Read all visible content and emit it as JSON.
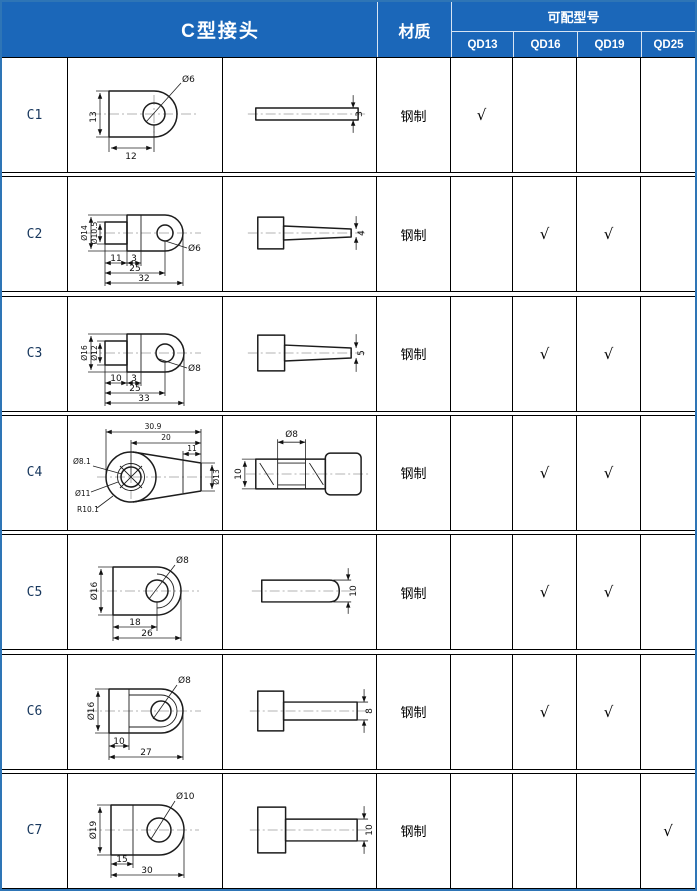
{
  "colors": {
    "header_bg": "#1b67b9",
    "outer_border": "#2e75b6",
    "grid_line": "#000000",
    "row_id_color": "#17375d"
  },
  "header": {
    "title": "C型接头",
    "material": "材质",
    "compat": "可配型号",
    "models": [
      "QD13",
      "QD16",
      "QD19",
      "QD25"
    ]
  },
  "rows": [
    {
      "id": "C1",
      "material": "钢制",
      "checkmarks": [
        "√",
        "",
        "",
        ""
      ],
      "front": {
        "hole": "Ø6",
        "height": "13",
        "width": "12"
      },
      "side": {
        "thickness": "3"
      }
    },
    {
      "id": "C2",
      "material": "钢制",
      "checkmarks": [
        "",
        "√",
        "√",
        ""
      ],
      "front": {
        "outer": "Ø14",
        "inner": "Ø10.5",
        "seg1": "11",
        "seg2": "3",
        "mid": "25",
        "total": "32",
        "hole": "Ø6"
      },
      "side": {
        "thickness": "4"
      }
    },
    {
      "id": "C3",
      "material": "钢制",
      "checkmarks": [
        "",
        "√",
        "√",
        ""
      ],
      "front": {
        "outer": "Ø16",
        "inner": "Ø12",
        "seg1": "10",
        "seg2": "3",
        "mid": "25",
        "total": "33",
        "hole": "Ø8"
      },
      "side": {
        "thickness": "5"
      }
    },
    {
      "id": "C4",
      "material": "钢制",
      "checkmarks": [
        "",
        "√",
        "√",
        ""
      ],
      "front": {
        "total": "30.9",
        "mid": "20",
        "seg": "11",
        "hole": "Ø8.1",
        "ring": "Ø11",
        "radius": "R10.1",
        "right": "Ø13"
      },
      "side": {
        "top": "Ø8",
        "height": "10"
      }
    },
    {
      "id": "C5",
      "material": "钢制",
      "checkmarks": [
        "",
        "√",
        "√",
        ""
      ],
      "front": {
        "outer": "Ø16",
        "hole": "Ø8",
        "seg": "18",
        "total": "26"
      },
      "side": {
        "thickness": "10"
      }
    },
    {
      "id": "C6",
      "material": "钢制",
      "checkmarks": [
        "",
        "√",
        "√",
        ""
      ],
      "front": {
        "outer": "Ø16",
        "hole": "Ø8",
        "seg": "10",
        "total": "27"
      },
      "side": {
        "thickness": "8"
      }
    },
    {
      "id": "C7",
      "material": "钢制",
      "checkmarks": [
        "",
        "",
        "",
        "√"
      ],
      "front": {
        "outer": "Ø19",
        "hole": "Ø10",
        "seg": "15",
        "total": "30"
      },
      "side": {
        "thickness": "10"
      }
    }
  ]
}
